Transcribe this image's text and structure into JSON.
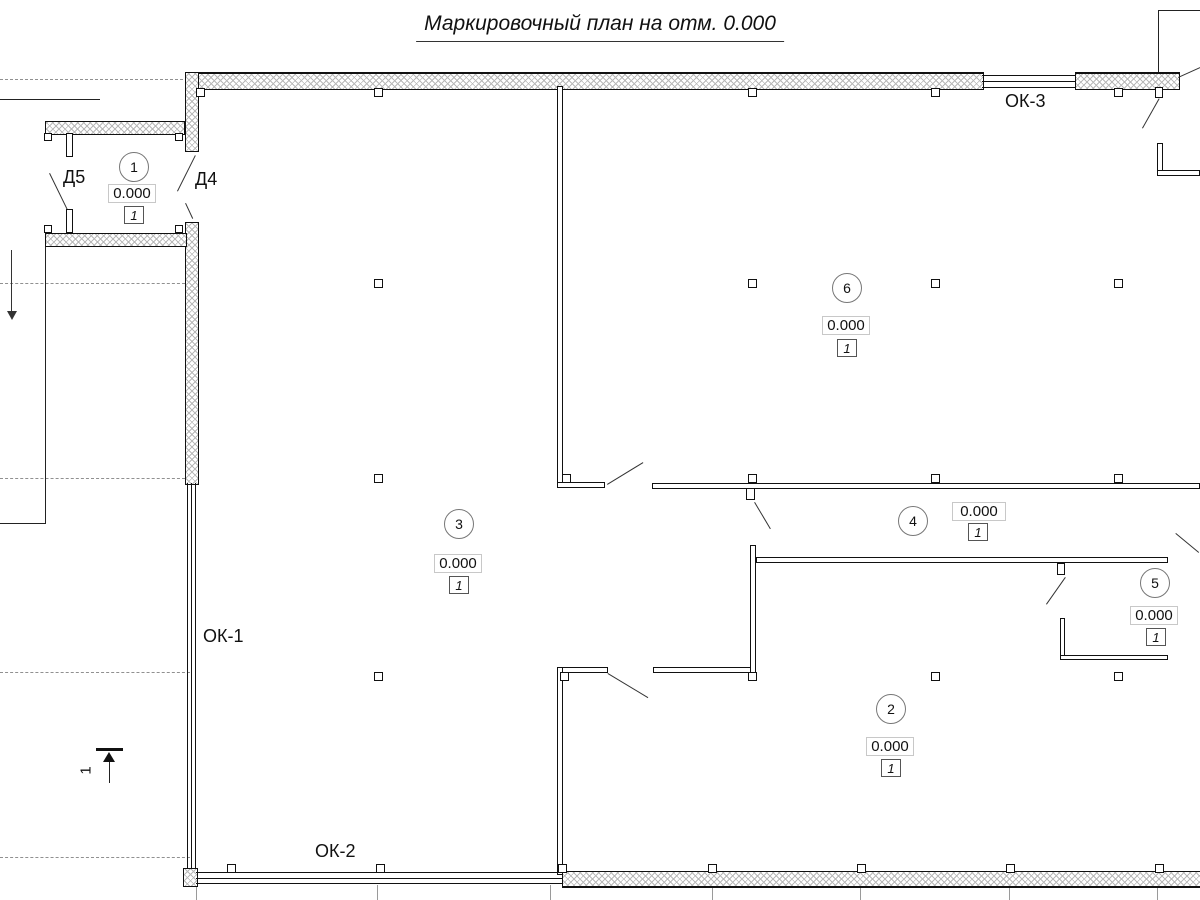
{
  "title": "Маркировочный план на отм. 0.000",
  "rooms": [
    {
      "number": "1",
      "elevation": "0.000",
      "floor_type": "1"
    },
    {
      "number": "2",
      "elevation": "0.000",
      "floor_type": "1"
    },
    {
      "number": "3",
      "elevation": "0.000",
      "floor_type": "1"
    },
    {
      "number": "4",
      "elevation": "0.000",
      "floor_type": "1"
    },
    {
      "number": "5",
      "elevation": "0.000",
      "floor_type": "1"
    },
    {
      "number": "6",
      "elevation": "0.000",
      "floor_type": "1"
    }
  ],
  "windows": [
    {
      "label": "ОК-1"
    },
    {
      "label": "ОК-2"
    },
    {
      "label": "ОК-3"
    }
  ],
  "doors": [
    {
      "label": "Д5"
    },
    {
      "label": "Д4"
    }
  ],
  "section_mark": {
    "number": "1"
  },
  "colors": {
    "line": "#111111",
    "hatch": "#b9b9b9",
    "light_box_border": "#c8c8c8",
    "gray_line": "#9a9a9a"
  }
}
